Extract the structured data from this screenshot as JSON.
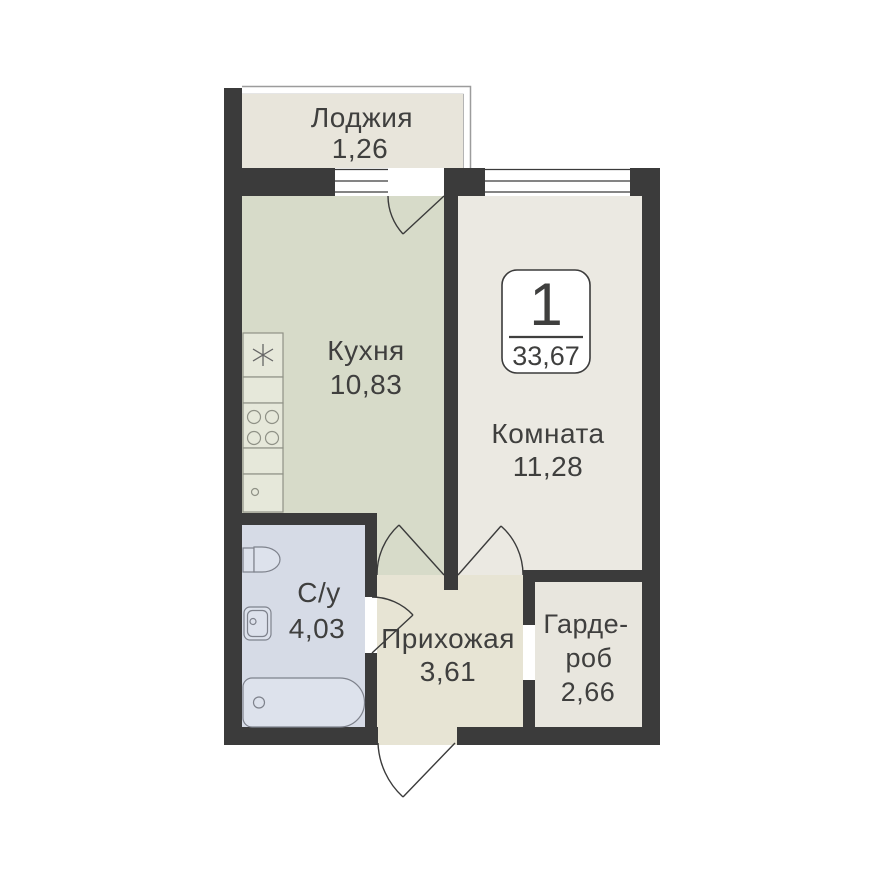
{
  "badge": {
    "rooms_count": "1",
    "total_area": "33,67"
  },
  "rooms": {
    "loggia": {
      "name": "Лоджия",
      "area": "1,26",
      "fill": "#e8e5db"
    },
    "kitchen": {
      "name": "Кухня",
      "area": "10,83",
      "fill": "#d7dbc9"
    },
    "living_room": {
      "name": "Комната",
      "area": "11,28",
      "fill": "#ebe9e2"
    },
    "bathroom": {
      "name": "С/у",
      "area": "4,03",
      "fill": "#d6dbe6"
    },
    "hallway": {
      "name": "Прихожая",
      "area": "3,61",
      "fill": "#e7e4d4"
    },
    "wardrobe": {
      "name": "Гардероб",
      "name_line1": "Гарде-",
      "name_line2": "роб",
      "area": "2,66",
      "fill": "#e8e6de"
    }
  },
  "colors": {
    "background": "#ffffff",
    "wall": "#3b3b3b",
    "text": "#3f3f3e",
    "door_line": "#3b3b3b",
    "window_line": "#3b3b3b",
    "window_fill": "#ffffff",
    "railing": "#9c9c9c",
    "kitchen_fixture_fill": "#e6e8da",
    "kitchen_fixture_stroke": "#8f9186",
    "bath_fixture_fill": "#dde2ec",
    "bath_fixture_stroke": "#7e828c",
    "badge_fill": "#ffffff",
    "badge_border": "#3b3b3b"
  }
}
